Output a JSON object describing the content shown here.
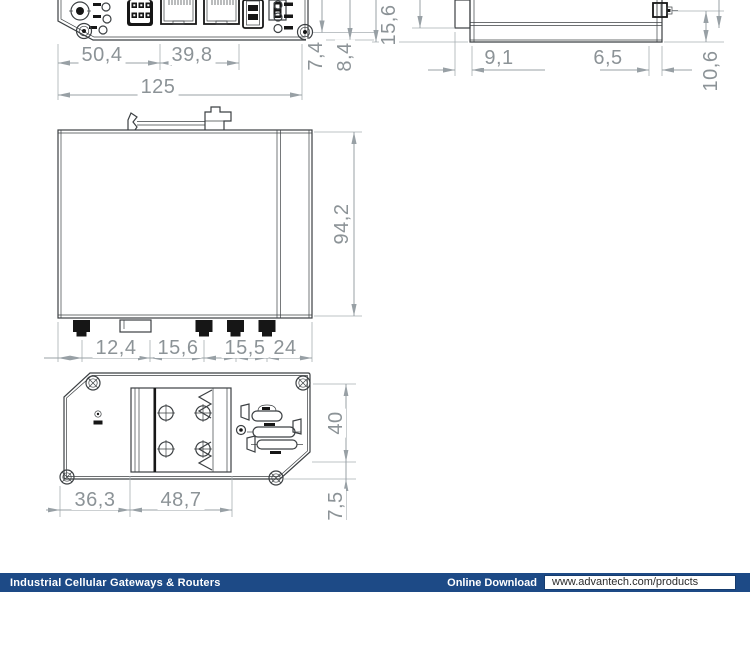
{
  "colors": {
    "footer_bar": "#1d4a86",
    "dimension_line": "#98a0a5",
    "dimension_text": "#8c9397",
    "drawing_outline": "#3c4043"
  },
  "views": {
    "front_panel": {
      "d_left": "50,4",
      "d_mid": "39,8",
      "d_total": "125",
      "d_v1": "7,4",
      "d_v2": "8,4"
    },
    "side_detail": {
      "d_height": "15,6",
      "d_left": "9,1",
      "d_right": "6,5",
      "d_conn": "10,6"
    },
    "side_view": {
      "d_height": "94,2",
      "d_b1": "12,4",
      "d_b2": "15,6",
      "d_b3": "15,5",
      "d_b4": "24"
    },
    "back_view": {
      "d_b1": "36,3",
      "d_b2": "48,7",
      "d_height": "40",
      "d_offset": "7,5"
    }
  },
  "footer": {
    "category_title": "Industrial Cellular Gateways & Routers",
    "download_label": "Online Download",
    "download_url": "www.advantech.com/products"
  }
}
